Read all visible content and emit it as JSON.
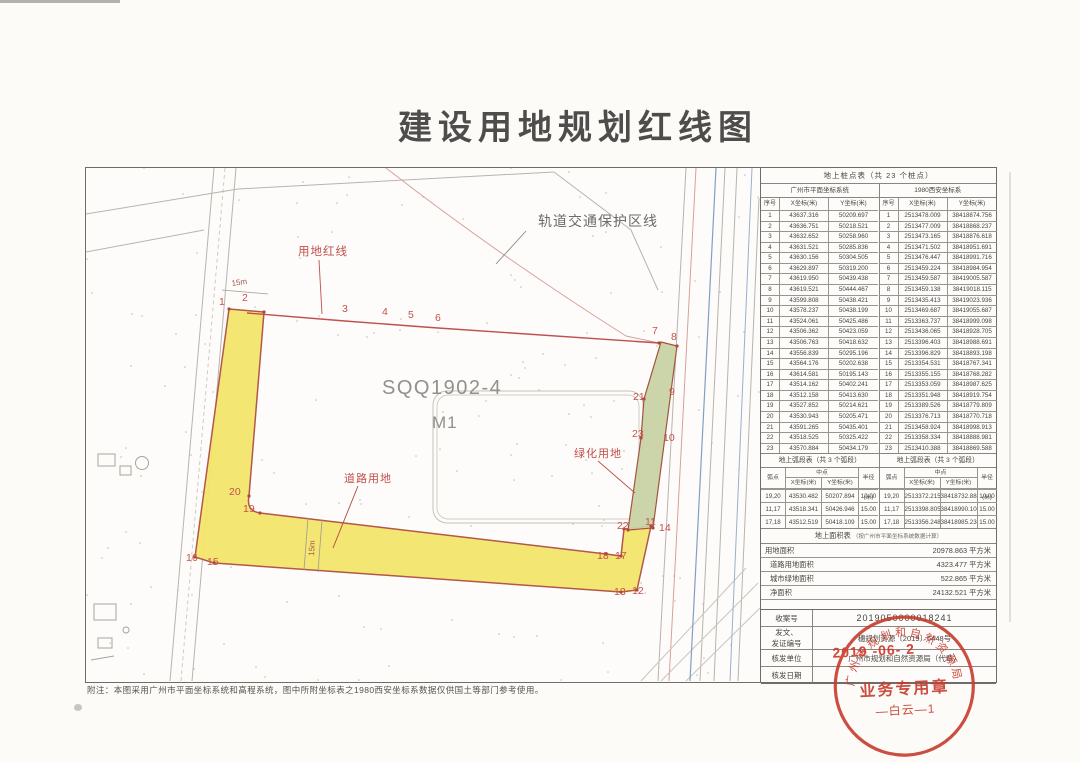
{
  "title": "建设用地规划红线图",
  "map": {
    "labels": {
      "rail_protection": "轨道交通保护区线",
      "red_line": "用地红线",
      "parcel_code": "SQQ1902-4",
      "parcel_use": "M1",
      "green_land": "绿化用地",
      "road_land": "道路用地",
      "dim_top": "15m",
      "dim_bottom": "15m"
    },
    "point_labels": [
      "1",
      "2",
      "3",
      "4",
      "5",
      "6",
      "7",
      "8",
      "9",
      "10",
      "11",
      "12",
      "13",
      "14",
      "15",
      "16",
      "17",
      "18",
      "19",
      "20",
      "21",
      "22",
      "23"
    ]
  },
  "point_table": {
    "title": "地上桩点表（共 23 个桩点）",
    "left_system": "广州市平面坐标系统",
    "right_system": "1980西安坐标系",
    "col_no": "序号",
    "col_x": "X坐标(米)",
    "col_y": "Y坐标(米)",
    "rows": [
      {
        "no": "1",
        "gz_x": "43637.316",
        "gz_y": "50209.697",
        "xa_x": "2513478.009",
        "xa_y": "38418874.756"
      },
      {
        "no": "2",
        "gz_x": "43636.751",
        "gz_y": "50218.521",
        "xa_x": "2513477.009",
        "xa_y": "38418868.237"
      },
      {
        "no": "3",
        "gz_x": "43632.652",
        "gz_y": "50258.960",
        "xa_x": "2513473.165",
        "xa_y": "38418876.618"
      },
      {
        "no": "4",
        "gz_x": "43631.521",
        "gz_y": "50285.836",
        "xa_x": "2513471.502",
        "xa_y": "38418951.691"
      },
      {
        "no": "5",
        "gz_x": "43630.156",
        "gz_y": "50304.505",
        "xa_x": "2513476.447",
        "xa_y": "38418991.716"
      },
      {
        "no": "6",
        "gz_x": "43629.897",
        "gz_y": "50319.200",
        "xa_x": "2513459.224",
        "xa_y": "38418984.954"
      },
      {
        "no": "7",
        "gz_x": "43619.950",
        "gz_y": "50439.438",
        "xa_x": "2513459.587",
        "xa_y": "38419005.587"
      },
      {
        "no": "8",
        "gz_x": "43619.521",
        "gz_y": "50444.467",
        "xa_x": "2513459.138",
        "xa_y": "38419018.115"
      },
      {
        "no": "9",
        "gz_x": "43599.808",
        "gz_y": "50438.421",
        "xa_x": "2513435.413",
        "xa_y": "38419023.936"
      },
      {
        "no": "10",
        "gz_x": "43578.237",
        "gz_y": "50438.199",
        "xa_x": "2513469.687",
        "xa_y": "38419055.687"
      },
      {
        "no": "11",
        "gz_x": "43524.061",
        "gz_y": "50425.486",
        "xa_x": "2513363.737",
        "xa_y": "38418999.098"
      },
      {
        "no": "12",
        "gz_x": "43506.362",
        "gz_y": "50423.059",
        "xa_x": "2513436.065",
        "xa_y": "38418928.705"
      },
      {
        "no": "13",
        "gz_x": "43506.763",
        "gz_y": "50418.632",
        "xa_x": "2513396.403",
        "xa_y": "38418988.691"
      },
      {
        "no": "14",
        "gz_x": "43556.839",
        "gz_y": "50295.196",
        "xa_x": "2513396.829",
        "xa_y": "38418893.198"
      },
      {
        "no": "15",
        "gz_x": "43564.176",
        "gz_y": "50202.638",
        "xa_x": "2513354.531",
        "xa_y": "38418767.341"
      },
      {
        "no": "16",
        "gz_x": "43614.581",
        "gz_y": "50195.143",
        "xa_x": "2513355.155",
        "xa_y": "38418768.282"
      },
      {
        "no": "17",
        "gz_x": "43514.162",
        "gz_y": "50402.241",
        "xa_x": "2513353.059",
        "xa_y": "38418987.625"
      },
      {
        "no": "18",
        "gz_x": "43512.158",
        "gz_y": "50413.630",
        "xa_x": "2513351.948",
        "xa_y": "38418919.754"
      },
      {
        "no": "19",
        "gz_x": "43527.852",
        "gz_y": "50214.621",
        "xa_x": "2513389.526",
        "xa_y": "38418779.809"
      },
      {
        "no": "20",
        "gz_x": "43530.943",
        "gz_y": "50205.471",
        "xa_x": "2513376.713",
        "xa_y": "38418770.718"
      },
      {
        "no": "21",
        "gz_x": "43591.265",
        "gz_y": "50435.401",
        "xa_x": "2513458.924",
        "xa_y": "38418998.913"
      },
      {
        "no": "22",
        "gz_x": "43518.525",
        "gz_y": "50325.422",
        "xa_x": "2513358.334",
        "xa_y": "38418888.981"
      },
      {
        "no": "23",
        "gz_x": "43570.884",
        "gz_y": "50434.179",
        "xa_x": "2513410.388",
        "xa_y": "38418869.588"
      }
    ]
  },
  "arc_table": {
    "title": "地上弧段表（共 3 个弧段）",
    "col_point": "弧点",
    "col_mid": "中点",
    "col_x": "X坐标(米)",
    "col_y": "Y坐标(米)",
    "col_radius": "半径(米)",
    "rows": [
      {
        "pts": "19,20",
        "gz_x": "43530.482",
        "gz_y": "50207.894",
        "gz_r": "10.00",
        "xa_x": "2513372.215",
        "xa_y": "38418732.888",
        "xa_r": "10.00"
      },
      {
        "pts": "11,17",
        "gz_x": "43518.341",
        "gz_y": "50426.946",
        "gz_r": "15.00",
        "xa_x": "2513398.805",
        "xa_y": "38418990.100",
        "xa_r": "15.00"
      },
      {
        "pts": "17,18",
        "gz_x": "43512.519",
        "gz_y": "50418.109",
        "gz_r": "15.00",
        "xa_x": "2513356.248",
        "xa_y": "38418985.234",
        "xa_r": "15.00"
      }
    ]
  },
  "area_table": {
    "title": "地上面积表",
    "note": "（按广州市平面坐标系统数据计算）",
    "rows": [
      {
        "label": "用地面积",
        "value": "20978.863",
        "unit": "平方米"
      },
      {
        "label": "道路用地面积",
        "value": "4323.477",
        "unit": "平方米"
      },
      {
        "label": "城市绿地面积",
        "value": "522.865",
        "unit": "平方米"
      },
      {
        "label": "净面积",
        "value": "24132.521",
        "unit": "平方米"
      }
    ]
  },
  "admin": {
    "case_no_label": "收案号",
    "case_no": "2019050000018241",
    "doc_label_line1": "发文、",
    "doc_label_line2": "发证编号",
    "doc_no": "穗规划资源〔2019〕6448号",
    "issuer_label": "核发单位",
    "issuer": "广州市规划和自然资源局（代章）",
    "date_label": "核发日期",
    "date_stamp": "2019 -06- 2"
  },
  "stamp": {
    "ring_text": "广州市规划和自然资源局",
    "center_line1": "业务专用章",
    "center_line2": "—白云—1"
  },
  "note": "附注：本图采用广州市平面坐标系统和高程系统，图中所附坐标表之1980西安坐标系数据仅供国土等部门参考使用。"
}
